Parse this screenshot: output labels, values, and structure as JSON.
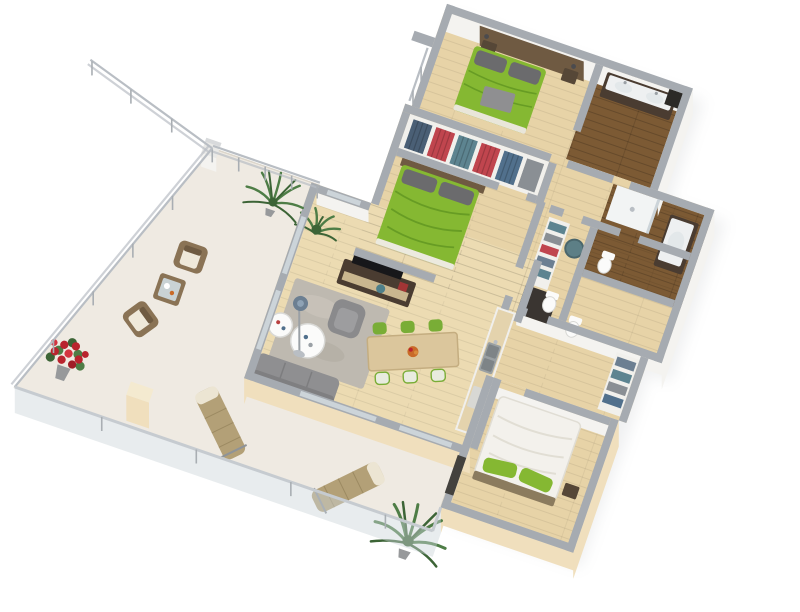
{
  "scene": {
    "kind": "3d-apartment-floor-plan-render",
    "background": "#ffffff",
    "view": "rotated top-down axonometric",
    "rotation_deg": 19
  },
  "palette": {
    "wallTop": "#a6abb1",
    "wallFace": "#f4f3f0",
    "wallCream": "#f0dfbd",
    "wood": "#e7d3a7",
    "woodLight": "#ecdbb2",
    "woodLine": "#c9b183",
    "darkWood": "#7c5a34",
    "darkWoodLine": "#694b28",
    "terrace": "#efeae2",
    "terraceEdge": "#dcd6cb",
    "green": "#85b832",
    "greenDark": "#679c24",
    "grayFurn": "#8f8f91",
    "grayDark": "#6b6b6d",
    "rug": "#beb9b0",
    "tableWood": "#dbc69c",
    "chairGreen": "#79ad36",
    "chairPale": "#e8ebdf",
    "consoleDark": "#4a3c31",
    "whiteFurn": "#fbfbfa",
    "bedWhite": "#f3f1ec",
    "clothesRed": "#c0454e",
    "clothesBlue": "#4a5f75",
    "teal": "#5d8490",
    "plant": "#4e7d46",
    "plantDark": "#3c6436",
    "flowers": "#b9242e",
    "wicker": "#8a7355",
    "wickerDark": "#6f5b42",
    "lounger": "#b3a077",
    "railing": "#b9bec4",
    "glass": "#ccd4d9",
    "headboard": "#6f5a42",
    "tvBlack": "#17171a",
    "sink": "#e3e8ea",
    "potGray": "#97999b",
    "shadow": "#8d939a"
  },
  "rooms": [
    {
      "id": "master-bedroom",
      "floor": "light-wood"
    },
    {
      "id": "bathroom-1",
      "floor": "dark-wood"
    },
    {
      "id": "walk-in-closet",
      "floor": "light-wood"
    },
    {
      "id": "hallway",
      "floor": "light-wood"
    },
    {
      "id": "bathroom-2",
      "floor": "dark-wood"
    },
    {
      "id": "wc",
      "floor": "light-wood"
    },
    {
      "id": "bedroom-2",
      "floor": "light-wood"
    },
    {
      "id": "living-room",
      "floor": "light-wood"
    },
    {
      "id": "dining-area",
      "floor": "light-wood"
    },
    {
      "id": "kitchen",
      "floor": "light-wood"
    },
    {
      "id": "bedroom-3",
      "floor": "light-wood"
    },
    {
      "id": "upper-terrace",
      "floor": "cream"
    },
    {
      "id": "lower-terrace",
      "floor": "cream"
    }
  ],
  "furniture": [
    "double-bed-green-master",
    "nightstands",
    "vanity-double-sink",
    "wardrobes-with-clothes",
    "double-bed-green-2",
    "tv-console",
    "tv",
    "sofa-gray",
    "armchair-gray",
    "round-side-tables",
    "floor-lamp",
    "area-rug",
    "dining-table",
    "dining-chairs-green",
    "kitchen-counter-sink",
    "toilets",
    "shelving-units",
    "shower",
    "bed-white-green-pillows",
    "wicker-armchairs",
    "wicker-coffee-table",
    "sun-loungers",
    "palm-plants",
    "red-flower-bush",
    "terrace-railings"
  ]
}
